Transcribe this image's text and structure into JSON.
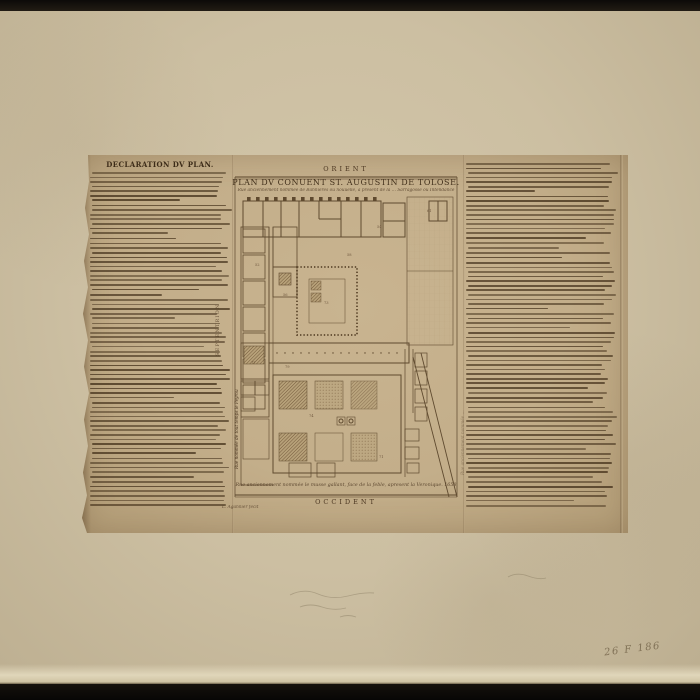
{
  "archive": {
    "shelfmark_handwritten": "26 F 186"
  },
  "print": {
    "left_column": {
      "heading": "DECLARATION DV PLAN."
    },
    "plan": {
      "orientation": {
        "top": "ORIENT",
        "bottom": "OCCIDENT",
        "left": "SEPTENTRION"
      },
      "title": "PLAN DV CONUENT ST. AUGUSTIN DE TOLOSE.",
      "subtitle": "Rue anciennement nommée de Bannieres ou nouuelle, à present de la … Sarragosse ou Intendance",
      "street_left": "Rue nommée de tout temps le Peyrou",
      "street_right": "Rue anciennement nommée …",
      "bottom_caption": "Rue anciennement nommée le musse gallant, face de la feble, apresent la Veronique. 1658",
      "signature": "L. Agannier fecit",
      "figure_labels": [
        "52",
        "56",
        "58",
        "54",
        "61",
        "73",
        "74",
        "71",
        "77",
        "79"
      ]
    }
  }
}
